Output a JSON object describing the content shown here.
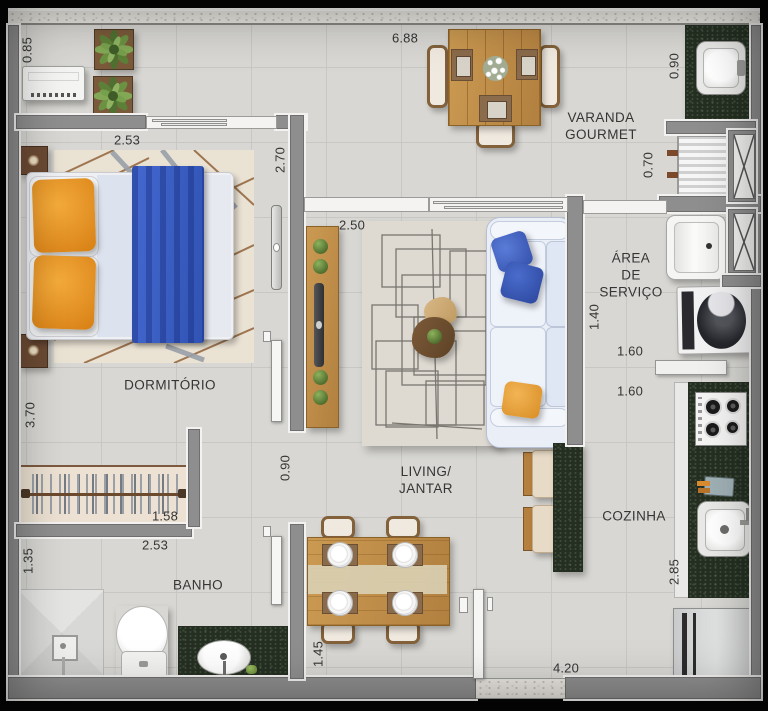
{
  "rooms": {
    "dormitorio": "DORMITÓRIO",
    "banho": "BANHO",
    "living": [
      "LIVING/",
      "JANTAR"
    ],
    "varanda": [
      "VARANDA",
      "GOURMET"
    ],
    "servico": [
      "ÁREA",
      "DE",
      "SERVIÇO"
    ],
    "cozinha": "COZINHA"
  },
  "dimensions": {
    "varanda_height_left": "0.85",
    "varanda_width_total": "6.88",
    "varanda_sink_depth": "0.90",
    "dormitorio_width": "2.53",
    "dormitorio_window_height": "2.70",
    "churrasqueira_depth": "0.70",
    "living_tv_wall_width": "2.50",
    "sofa_wall_length": "1.40",
    "servico_width_upper": "1.60",
    "servico_width_lower": "1.60",
    "dormitorio_length": "3.70",
    "hall_passage_width": "0.90",
    "closet_width": "1.58",
    "banho_width": "2.53",
    "banho_depth": "1.35",
    "cozinha_counter_length": "2.85",
    "jantar_clearance": "1.45",
    "entry_wall_length": "4.20"
  },
  "colors": {
    "floor": "#d8d7d3",
    "grid": "#c8c7c3",
    "wall": "#8e8e8e",
    "wall_outline": "#6f6f6f",
    "halo": "#f3f2f0",
    "granite": "#242f21",
    "wood": "#c4924d",
    "wood_dark": "#8a6238",
    "accent_blue": "#3b62c6",
    "accent_light_blue": "#ccd7ea",
    "accent_orange": "#e8951f",
    "sofa": "#e9eef7",
    "label_text": "#353535",
    "plant_green": "#6e9243"
  }
}
